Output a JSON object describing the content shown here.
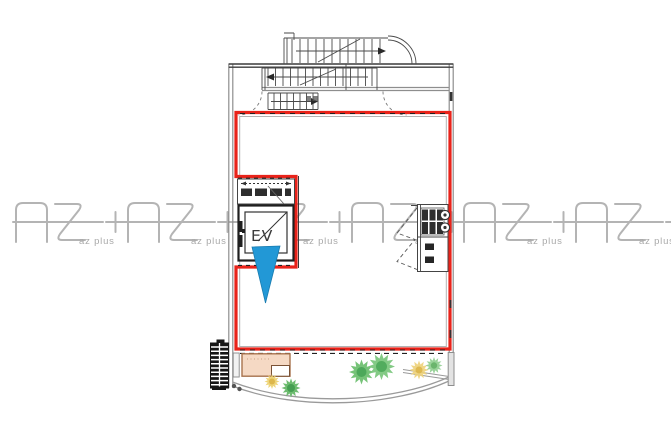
{
  "meta": {
    "title": "Architectural floor plan with elevator and red unit boundary",
    "drawing_type": "floor-plan"
  },
  "watermark": {
    "logo_text": "AZ+",
    "subtext": "az plus",
    "color": "#acacac",
    "instances": 6
  },
  "plan": {
    "elevator_label": "EV",
    "unit_boundary_color": "#e8231a",
    "pointer_arrow_color": "#2298d6",
    "terrace_mat_color": "#f5d9c4",
    "wall_color": "#8e8e8e",
    "plant_green": "#6fc071",
    "plant_yellow": "#ecd06b"
  }
}
